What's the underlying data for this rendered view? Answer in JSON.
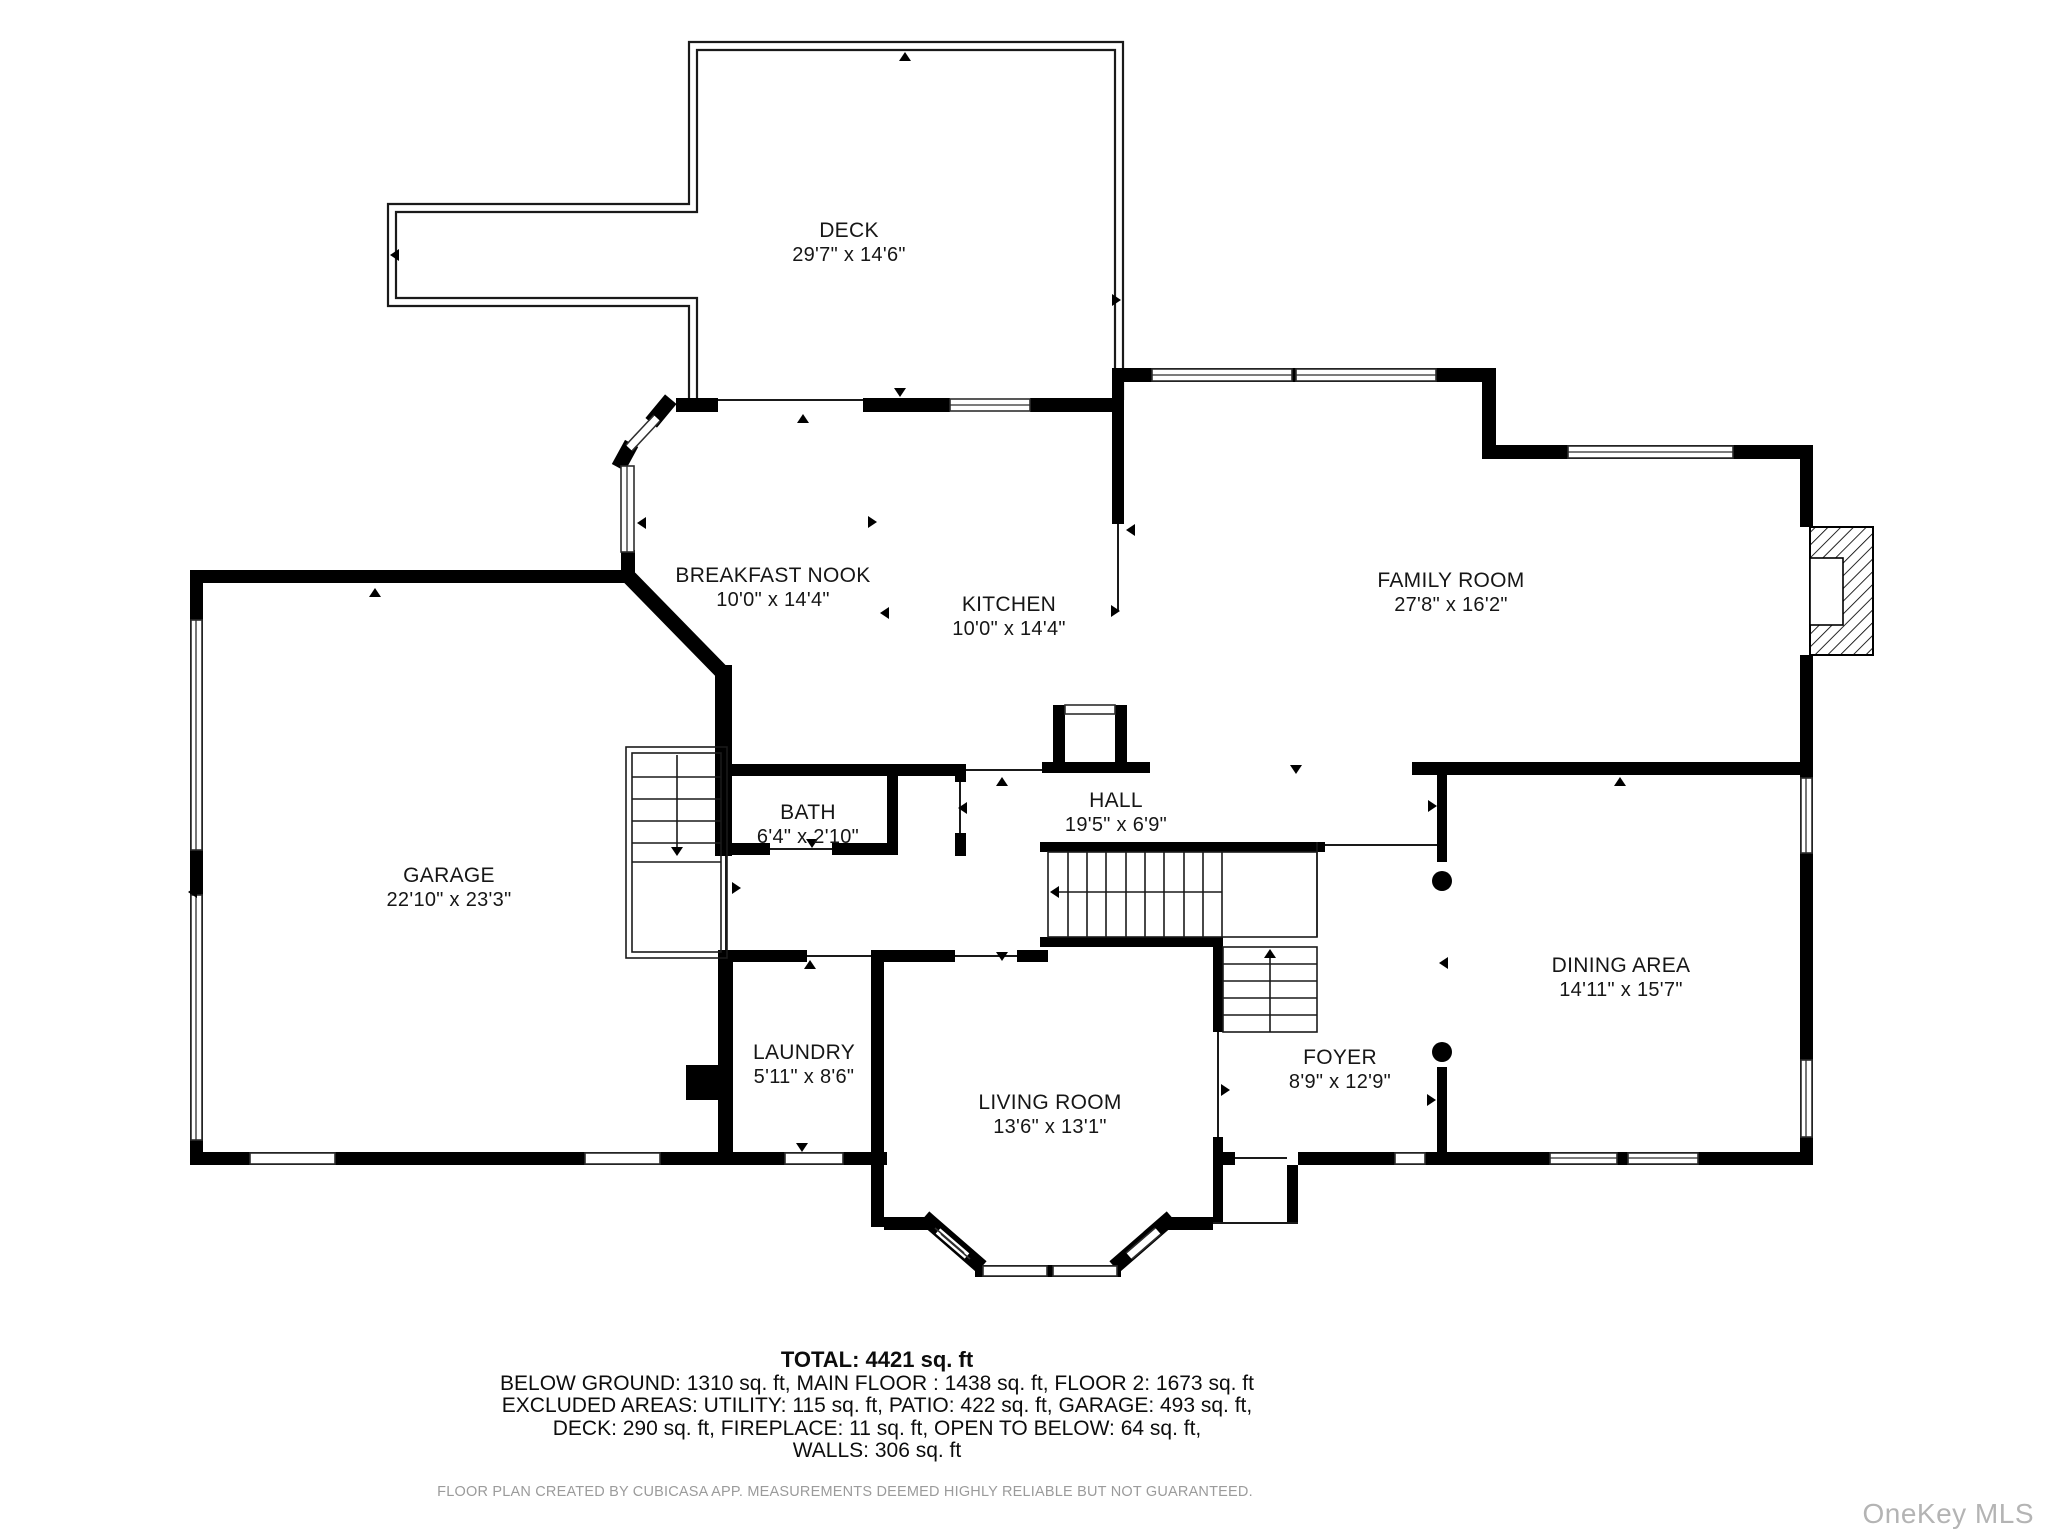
{
  "rooms": [
    {
      "id": "deck",
      "name": "DECK",
      "dims": "29'7\" x 14'6\"",
      "cx": 849,
      "cy": 219
    },
    {
      "id": "breakfast-nook",
      "name": "BREAKFAST NOOK",
      "dims": "10'0\" x 14'4\"",
      "cx": 773,
      "cy": 564
    },
    {
      "id": "kitchen",
      "name": "KITCHEN",
      "dims": "10'0\" x 14'4\"",
      "cx": 1009,
      "cy": 593
    },
    {
      "id": "family-room",
      "name": "FAMILY ROOM",
      "dims": "27'8\" x 16'2\"",
      "cx": 1451,
      "cy": 569
    },
    {
      "id": "garage",
      "name": "GARAGE",
      "dims": "22'10\" x 23'3\"",
      "cx": 449,
      "cy": 864
    },
    {
      "id": "bath",
      "name": "BATH",
      "dims": "6'4\" x 2'10\"",
      "cx": 808,
      "cy": 801
    },
    {
      "id": "hall",
      "name": "HALL",
      "dims": "19'5\" x 6'9\"",
      "cx": 1116,
      "cy": 789
    },
    {
      "id": "laundry",
      "name": "LAUNDRY",
      "dims": "5'11\" x 8'6\"",
      "cx": 804,
      "cy": 1041
    },
    {
      "id": "living-room",
      "name": "LIVING ROOM",
      "dims": "13'6\" x 13'1\"",
      "cx": 1050,
      "cy": 1091
    },
    {
      "id": "foyer",
      "name": "FOYER",
      "dims": "8'9\" x 12'9\"",
      "cx": 1340,
      "cy": 1046
    },
    {
      "id": "dining-area",
      "name": "DINING AREA",
      "dims": "14'11\" x 15'7\"",
      "cx": 1621,
      "cy": 954
    }
  ],
  "summary": {
    "total": "TOTAL: 4421 sq. ft",
    "line1": "BELOW GROUND: 1310 sq. ft, MAIN FLOOR : 1438 sq. ft, FLOOR 2: 1673 sq. ft",
    "line2": "EXCLUDED AREAS: UTILITY: 115 sq. ft, PATIO: 422 sq. ft, GARAGE: 493 sq. ft,",
    "line3": "DECK: 290 sq. ft, FIREPLACE: 11 sq. ft, OPEN TO BELOW: 64 sq. ft,",
    "line4": "WALLS: 306 sq. ft"
  },
  "disclaimer": "FLOOR PLAN CREATED BY CUBICASA APP. MEASUREMENTS DEEMED HIGHLY RELIABLE BUT NOT GUARANTEED.",
  "watermark": "OneKey MLS",
  "colors": {
    "wall": "#000000",
    "text": "#161616",
    "disclaimer": "#9b9b9b",
    "watermark": "#b4b4b4",
    "bg": "#ffffff"
  }
}
